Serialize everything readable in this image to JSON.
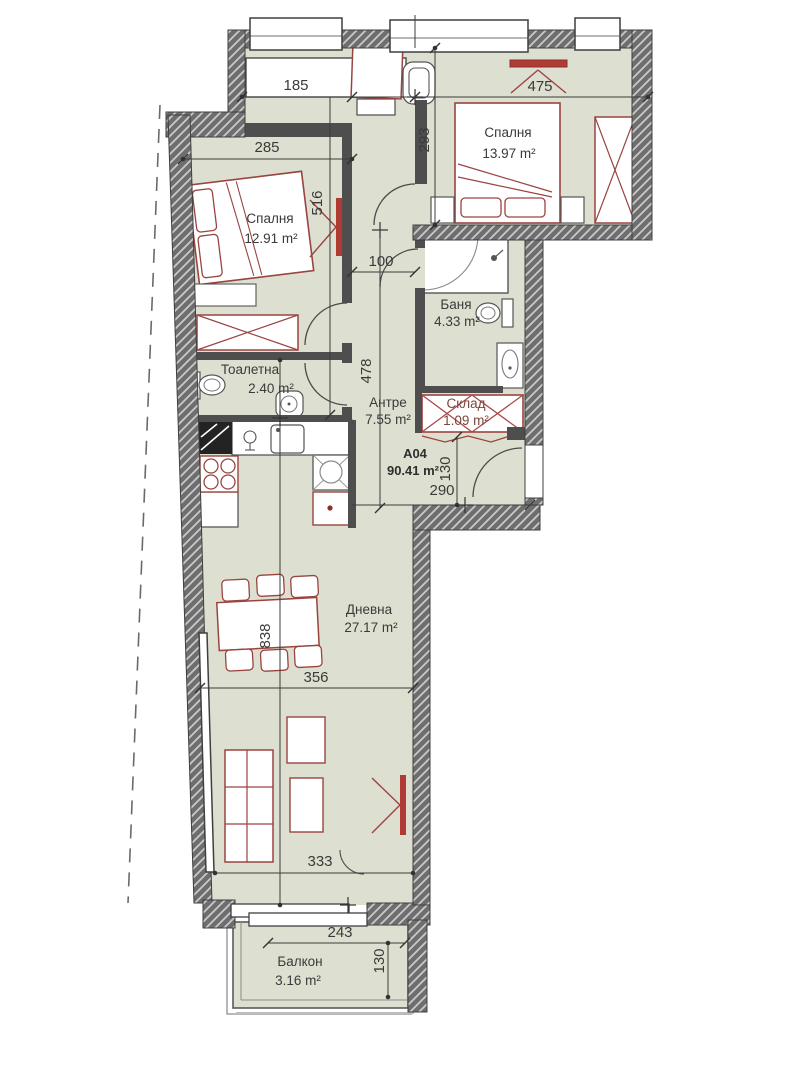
{
  "plan": {
    "unit": {
      "code": "A04",
      "area": "90.41 m²"
    },
    "rooms": {
      "bedroom1": {
        "name": "Спалня",
        "area": "12.91 m²"
      },
      "bedroom2": {
        "name": "Спалня",
        "area": "13.97 m²"
      },
      "bathroom": {
        "name": "Баня",
        "area": "4.33 m²"
      },
      "toilet": {
        "name": "Тоалетна",
        "area": "2.40 m²"
      },
      "hallway": {
        "name": "Антре",
        "area": "7.55 m²"
      },
      "storage": {
        "name": "Склад",
        "area": "1.09 m²"
      },
      "living": {
        "name": "Дневна",
        "area": "27.17 m²"
      },
      "balcony": {
        "name": "Балкон",
        "area": "3.16 m²"
      }
    },
    "dims": {
      "d185": "185",
      "d475": "475",
      "d285": "285",
      "d293": "293",
      "d516": "516",
      "d100": "100",
      "d478": "478",
      "d130_entry": "130",
      "d290": "290",
      "d838": "838",
      "d356": "356",
      "d333": "333",
      "d243": "243",
      "d130_balcony": "130"
    },
    "colors": {
      "room_fill": "#dde0d0",
      "wall_dark": "#4e4e4e",
      "wall_hatch_bg": "#6e6e6e",
      "furniture_red": "#9a4440",
      "tv_red": "#b03b35",
      "dim_text": "#3a3a3a"
    }
  }
}
